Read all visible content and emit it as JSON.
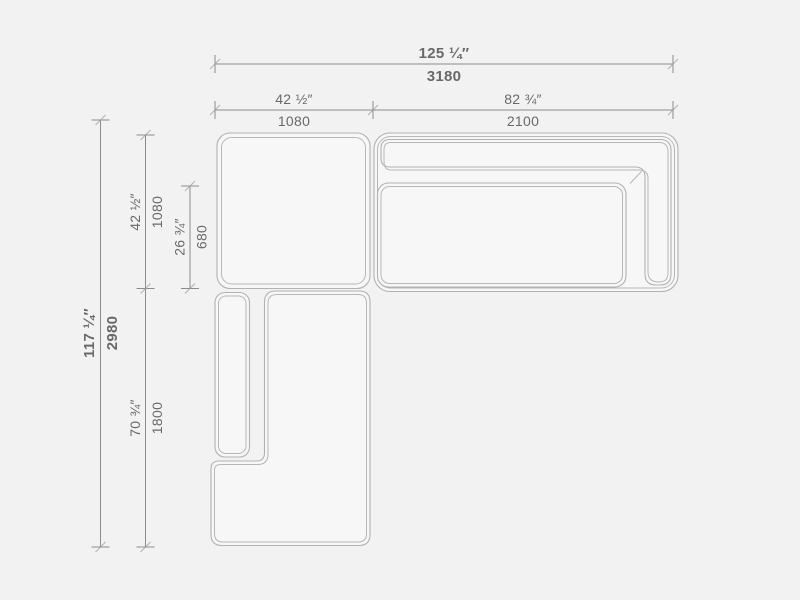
{
  "drawing": {
    "kind": "sectional-sofa-top-view-dimension-drawing",
    "modules": [
      "corner-seat",
      "right-sofa-with-back-and-arm",
      "chaise-with-left-arm"
    ]
  },
  "colors": {
    "background": "#f2f2f2",
    "furniture_line": "#b2b2b2",
    "furniture_fill": "#f7f7f7",
    "dimension_line": "#8c8c8c",
    "text": "#696969"
  },
  "dimensions": {
    "overall_width": {
      "inch": "125 ¼″",
      "mm": "3180"
    },
    "left_module_width": {
      "inch": "42 ½″",
      "mm": "1080"
    },
    "right_module_width": {
      "inch": "82 ¾″",
      "mm": "2100"
    },
    "overall_depth": {
      "inch": "117 ¼″",
      "mm": "2980"
    },
    "left_module_depth": {
      "inch": "42 ½″",
      "mm": "1080"
    },
    "seat_depth": {
      "inch": "26 ¾″",
      "mm": "680"
    },
    "chaise_length": {
      "inch": "70 ¾″",
      "mm": "1800"
    }
  }
}
